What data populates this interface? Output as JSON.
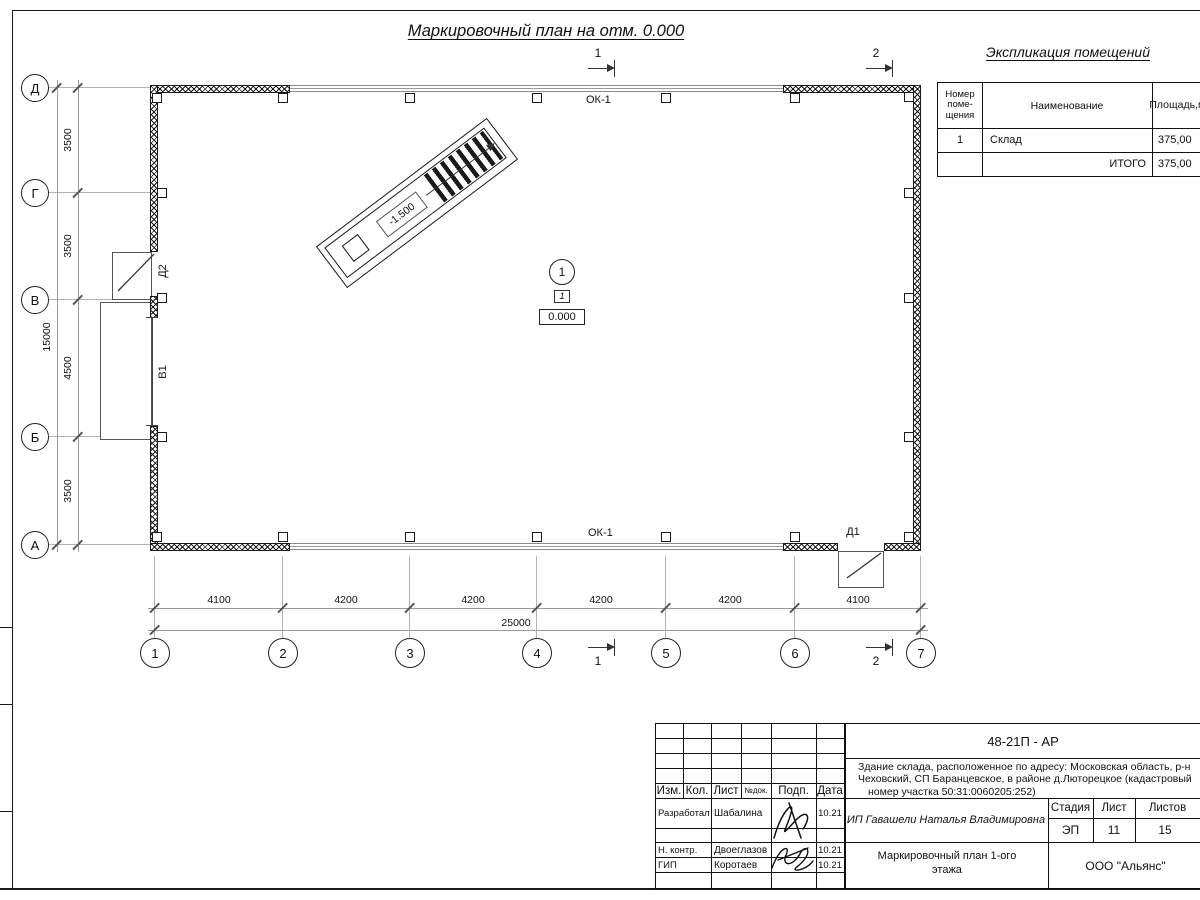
{
  "sheet": {
    "plan_title": "Маркировочный план на отм. 0.000"
  },
  "explication": {
    "title": "Экспликация помещений",
    "col_room_number": "Номер\nпоме-\nщения",
    "col_name": "Наименование",
    "col_area_line1": "Площадь,",
    "col_area_line2": "м²",
    "row1_number": "1",
    "row1_name": "Склад",
    "row1_area": "375,00",
    "total_label": "ИТОГО",
    "total_area": "375,00"
  },
  "axes": {
    "v0": "Д",
    "v1": "Г",
    "v2": "В",
    "v3": "Б",
    "v4": "А",
    "h0": "1",
    "h1": "2",
    "h2": "3",
    "h3": "4",
    "h4": "5",
    "h5": "6",
    "h6": "7"
  },
  "dimensions": {
    "left0": "3500",
    "left1": "3500",
    "left2": "4500",
    "left3": "3500",
    "left_total": "15000",
    "bot0": "4100",
    "bot1": "4200",
    "bot2": "4200",
    "bot3": "4200",
    "bot4": "4200",
    "bot5": "4100",
    "bot_total": "25000"
  },
  "plan_labels": {
    "window_top": "ОК-1",
    "window_bottom": "ОК-1",
    "door_d2": "Д2",
    "gate_v1": "В1",
    "door_d1": "Д1",
    "ramp_level": "-1.500",
    "room_number_circle": "1",
    "room_number_box": "1",
    "floor_level": "0.000",
    "section_1": "1",
    "section_2": "2"
  },
  "titleblock": {
    "doc_number": "48-21П - АР",
    "object_line1": "Здание склада, расположенное по адресу: Московская область, р-н",
    "object_line2": "Чеховский, СП Баранцевское, в районе д.Люторецкое  (кадастровый",
    "object_line3": "номер участка 50:31:0060205:252)",
    "client": "ИП Гавашели Наталья Владимировна",
    "sheet_title_line1": "Маркировочный план 1-ого",
    "sheet_title_line2": "этажа",
    "company": "ООО \"Альянс\"",
    "col_izm": "Изм.",
    "col_kol": "Кол.",
    "col_list": "Лист",
    "col_ndok": "№док.",
    "col_podp": "Подп.",
    "col_data": "Дата",
    "stage_label": "Стадия",
    "stage_value": "ЭП",
    "sheet_label": "Лист",
    "sheet_value": "11",
    "sheets_label": "Листов",
    "sheets_value": "15",
    "row1_role": "Разработал",
    "row1_name": "Шабалина",
    "row1_date": "10.21",
    "row2_role": "Н. контр.",
    "row2_name": "Двоеглазов",
    "row2_date": "10.21",
    "row3_role": "ГИП",
    "row3_name": "Коротаев",
    "row3_date": "10.21"
  }
}
